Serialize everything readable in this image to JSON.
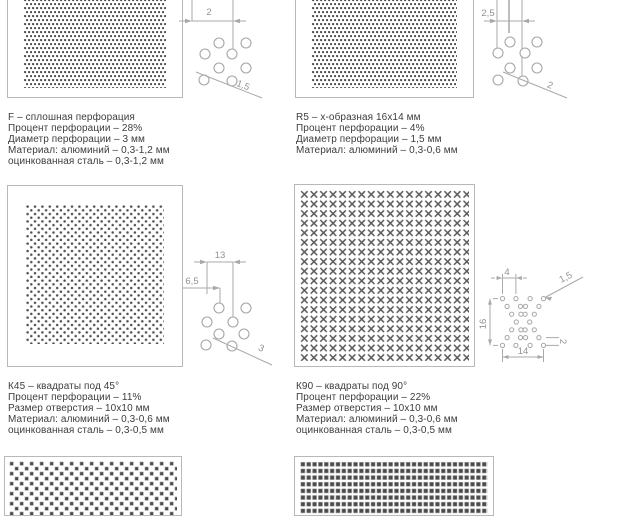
{
  "page_title": "Перфорация - каталог перфорированных панелей",
  "sections": [
    {
      "code": "F",
      "title": "F – сплошная перфорация",
      "specs": [
        "Процент перфорации – 28%",
        "Диаметр перфорации – 3 мм",
        "Материал: алюминий – 0,3-1,2 мм",
        "оцинкованная сталь – 0,3-1,2 мм"
      ],
      "dims": {
        "pitch": "2",
        "diameter": "1,5"
      }
    },
    {
      "code": "R5",
      "title": "R5 – x-образная 16x14 мм",
      "specs": [
        "Процент перфорации – 4%",
        "Диаметр перфорации – 1,5 мм",
        "Материал: алюминий – 0,3-0,6 мм"
      ],
      "dims": {
        "pitch": "2,5",
        "diameter": "2"
      }
    },
    {
      "code": "K45",
      "title": "К45 – квадраты под 45°",
      "specs": [
        "Процент перфорации – 11%",
        "Размер отверстия – 10x10 мм",
        "Материал: алюминий – 0,3-0,6 мм",
        "оцинкованная сталь – 0,3-0,5 мм"
      ],
      "dims": {
        "width": "13",
        "half": "6,5",
        "diameter": "3"
      }
    },
    {
      "code": "K90",
      "title": "К90 – квадраты под 90°",
      "specs": [
        "Процент перфорации – 22%",
        "Размер отверстия – 10x10 мм",
        "Материал: алюминий – 0,3-0,6 мм",
        "оцинкованная сталь – 0,3-0,5 мм"
      ],
      "dims": {
        "top": "4",
        "height": "16",
        "width": "14",
        "diameter": "1,5",
        "spacing": "2"
      }
    }
  ],
  "colors": {
    "hole_dark": "#4e4e4e",
    "border_gray": "#b8b8b8",
    "dim_gray": "#a9a9a9",
    "text_dark": "#3d3d3d"
  }
}
